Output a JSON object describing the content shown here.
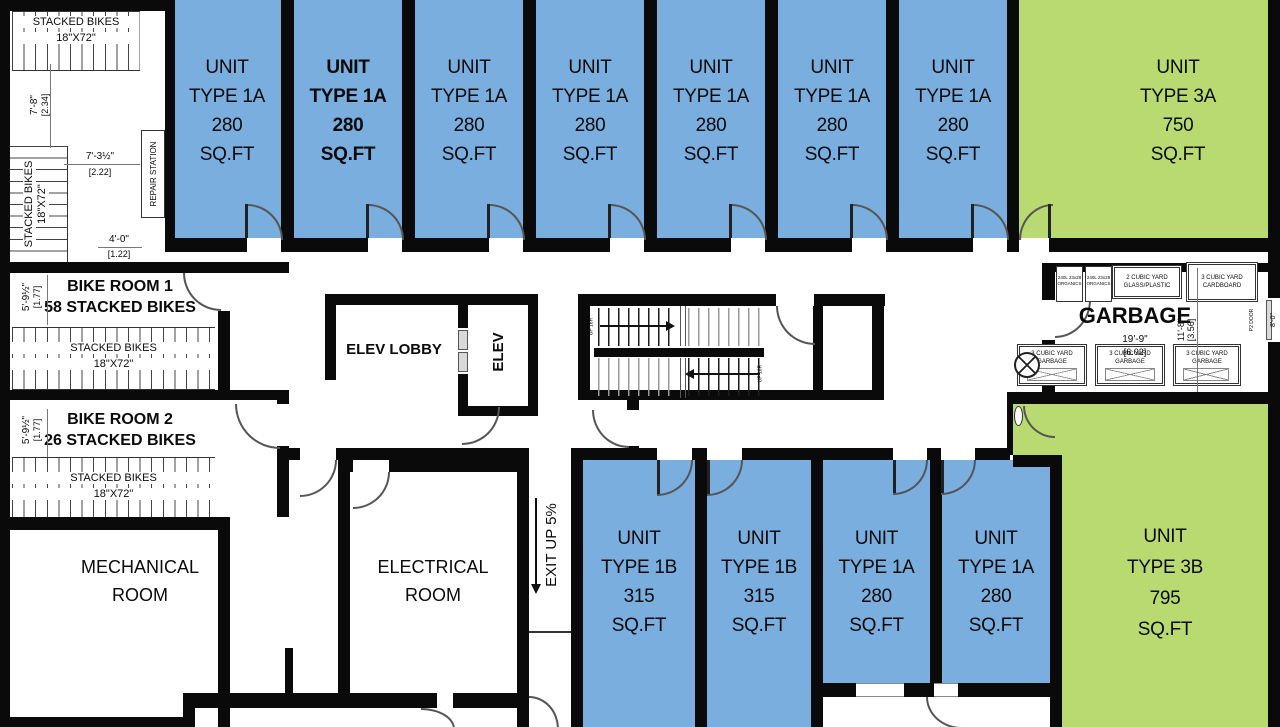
{
  "colors": {
    "unit_blue": "#7aaede",
    "unit_green": "#b9da70",
    "wall": "#0a0a0a"
  },
  "units": {
    "top": [
      {
        "l1": "UNIT",
        "l2": "TYPE 1A",
        "l3": "280",
        "l4": "SQ.FT"
      },
      {
        "l1": "UNIT",
        "l2": "TYPE 1A",
        "l3": "280",
        "l4": "SQ.FT"
      },
      {
        "l1": "UNIT",
        "l2": "TYPE 1A",
        "l3": "280",
        "l4": "SQ.FT"
      },
      {
        "l1": "UNIT",
        "l2": "TYPE 1A",
        "l3": "280",
        "l4": "SQ.FT"
      },
      {
        "l1": "UNIT",
        "l2": "TYPE 1A",
        "l3": "280",
        "l4": "SQ.FT"
      },
      {
        "l1": "UNIT",
        "l2": "TYPE 1A",
        "l3": "280",
        "l4": "SQ.FT"
      },
      {
        "l1": "UNIT",
        "l2": "TYPE 1A",
        "l3": "280",
        "l4": "SQ.FT"
      }
    ],
    "type3a": {
      "l1": "UNIT",
      "l2": "TYPE 3A",
      "l3": "750",
      "l4": "SQ.FT"
    },
    "bottom": [
      {
        "l1": "UNIT",
        "l2": "TYPE 1B",
        "l3": "315",
        "l4": "SQ.FT"
      },
      {
        "l1": "UNIT",
        "l2": "TYPE 1B",
        "l3": "315",
        "l4": "SQ.FT"
      },
      {
        "l1": "UNIT",
        "l2": "TYPE 1A",
        "l3": "280",
        "l4": "SQ.FT"
      },
      {
        "l1": "UNIT",
        "l2": "TYPE 1A",
        "l3": "280",
        "l4": "SQ.FT"
      }
    ],
    "type3b": {
      "l1": "UNIT",
      "l2": "TYPE 3B",
      "l3": "795",
      "l4": "SQ.FT"
    }
  },
  "bike": {
    "room1_title": "BIKE ROOM 1",
    "room1_sub": "58 STACKED BIKES",
    "room2_title": "BIKE ROOM 2",
    "room2_sub": "26 STACKED BIKES",
    "rack_line1": "STACKED BIKES",
    "rack_line2": "18\"X72\"",
    "repair_station": "REPAIR STATION"
  },
  "rooms": {
    "elev_lobby": "ELEV LOBBY",
    "elev": "ELEV",
    "mechanical_l1": "MECHANICAL",
    "mechanical_l2": "ROOM",
    "electrical_l1": "ELECTRICAL",
    "electrical_l2": "ROOM",
    "exit_ramp": "EXIT UP 5%",
    "garbage": "GARBAGE"
  },
  "stairs": {
    "flight1_label": "UP 16R",
    "flight2_label": "UP 16R"
  },
  "garbage": {
    "organics_l1": "240L 23x28",
    "organics_l2": "ORGANICS",
    "glass_l1": "2 CUBIC YARD",
    "glass_l2": "GLASS/PLASTIC",
    "cardboard_l1": "3 CUBIC YARD",
    "cardboard_l2": "CARDBOARD",
    "bin_l1": "3 CUBIC YARD",
    "bin_l2": "GARBAGE",
    "p2_door": "P2 DOOR",
    "dim_w_a": "19'-9\"",
    "dim_w_b": "[6.02]",
    "dim_h_a": "11'-8\"",
    "dim_h_b": "[3.56]",
    "dim_door": "8'-0\""
  },
  "dims": {
    "alcove_v_a": "7'-8\"",
    "alcove_v_b": "[2.34]",
    "alcove_h_a": "7'-3½\"",
    "alcove_h_b": "[2.22]",
    "alcove_e_a": "4'-0\"",
    "alcove_e_b": "[1.22]",
    "room1_a": "5'-9½\"",
    "room1_b": "[1.77]",
    "room2_a": "5'-9½\"",
    "room2_b": "[1.77]"
  }
}
